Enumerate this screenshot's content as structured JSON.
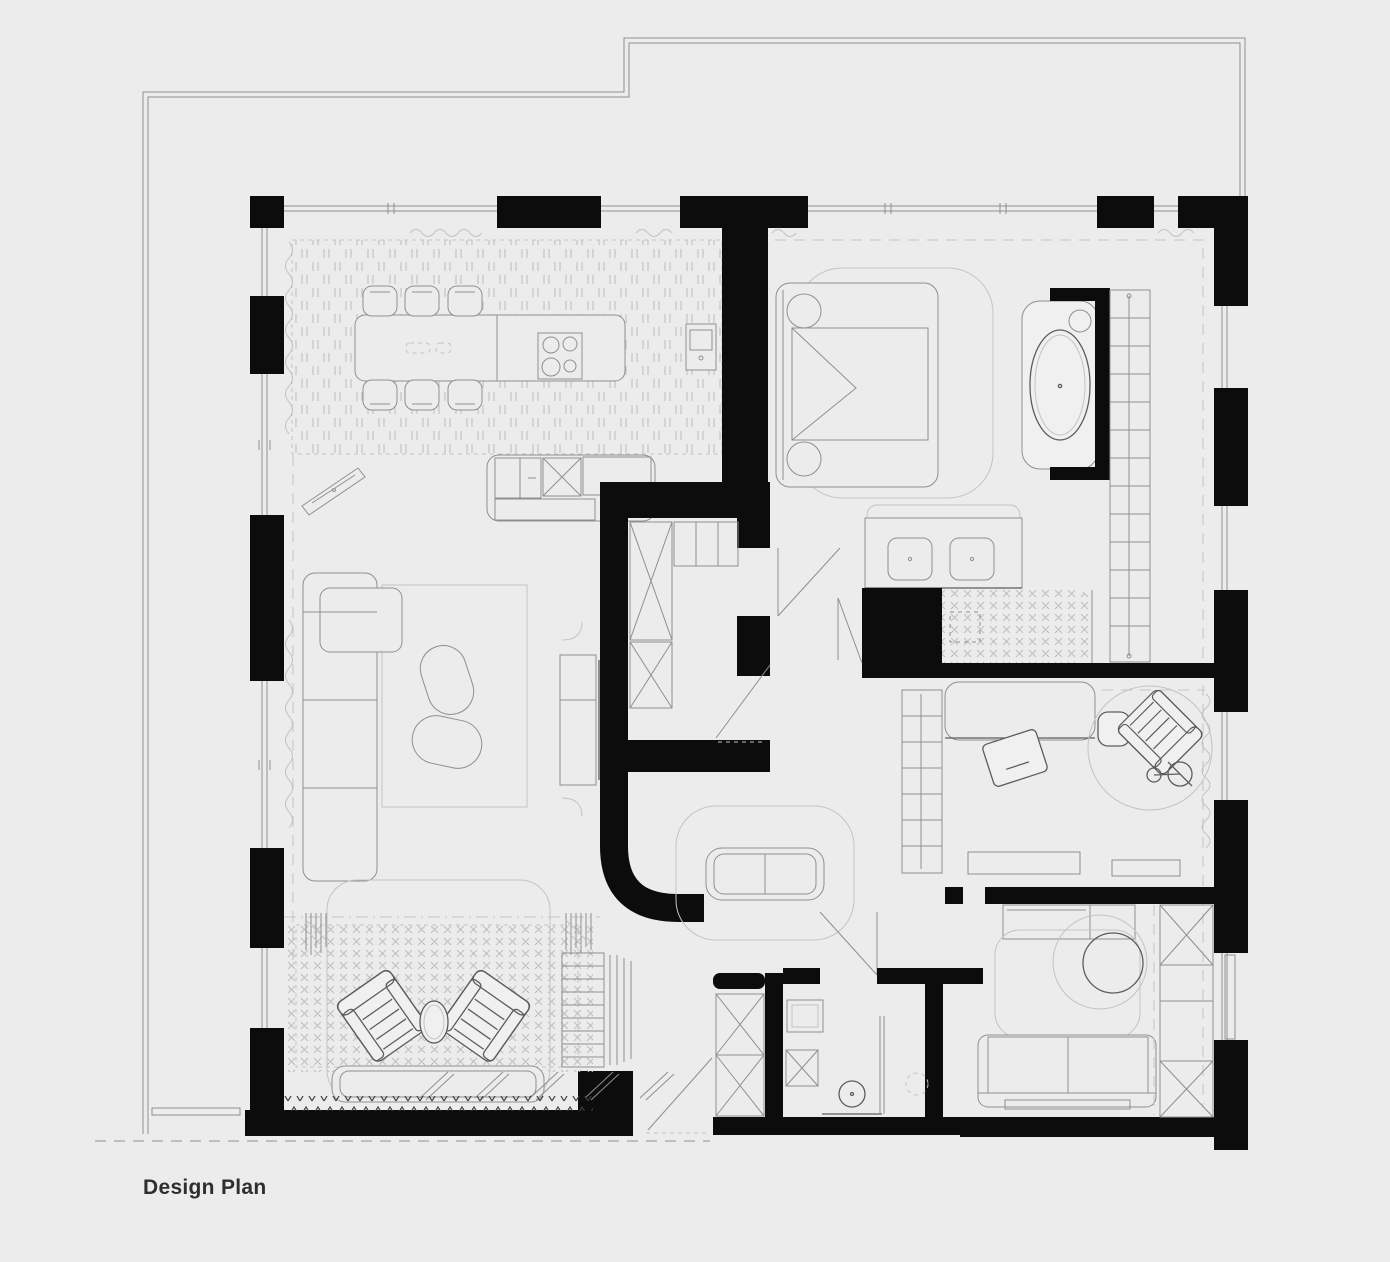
{
  "title": {
    "label": "Design Plan"
  },
  "palette": {
    "background": "#ececec",
    "wall": "#0c0c0c",
    "line": "#8f8f8f",
    "line_light": "#c3c3c3",
    "line_dark": "#5c5c5c",
    "furniture_fill": "#f0f0f0",
    "hatch": "#c0c0c0",
    "text": "#2e2e2e"
  }
}
